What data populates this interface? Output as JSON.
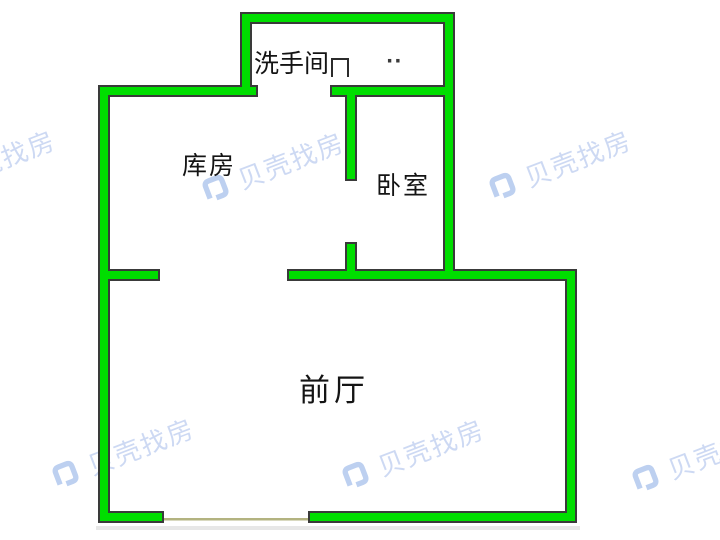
{
  "watermark": {
    "text": "贝壳找房",
    "logo_icon": "beike-shell-logo-icon",
    "text_color": "#cdd9f3",
    "logo_color": "#bdd0f0"
  },
  "rooms": {
    "bathroom": {
      "label": "洗手间",
      "marks": "··"
    },
    "storage": {
      "label": "库房"
    },
    "bedroom": {
      "label": "卧室"
    },
    "front_hall": {
      "label": "前厅"
    }
  },
  "icons": {
    "bathroom_door": "door-frame-icon"
  },
  "colors": {
    "wall_fill": "#00DE00",
    "wall_outline": "#3a3a3a",
    "room_label": "#141414",
    "door_threshold": "#b3b380",
    "wall_shadow": "#e7e7e7",
    "background": "#ffffff"
  }
}
